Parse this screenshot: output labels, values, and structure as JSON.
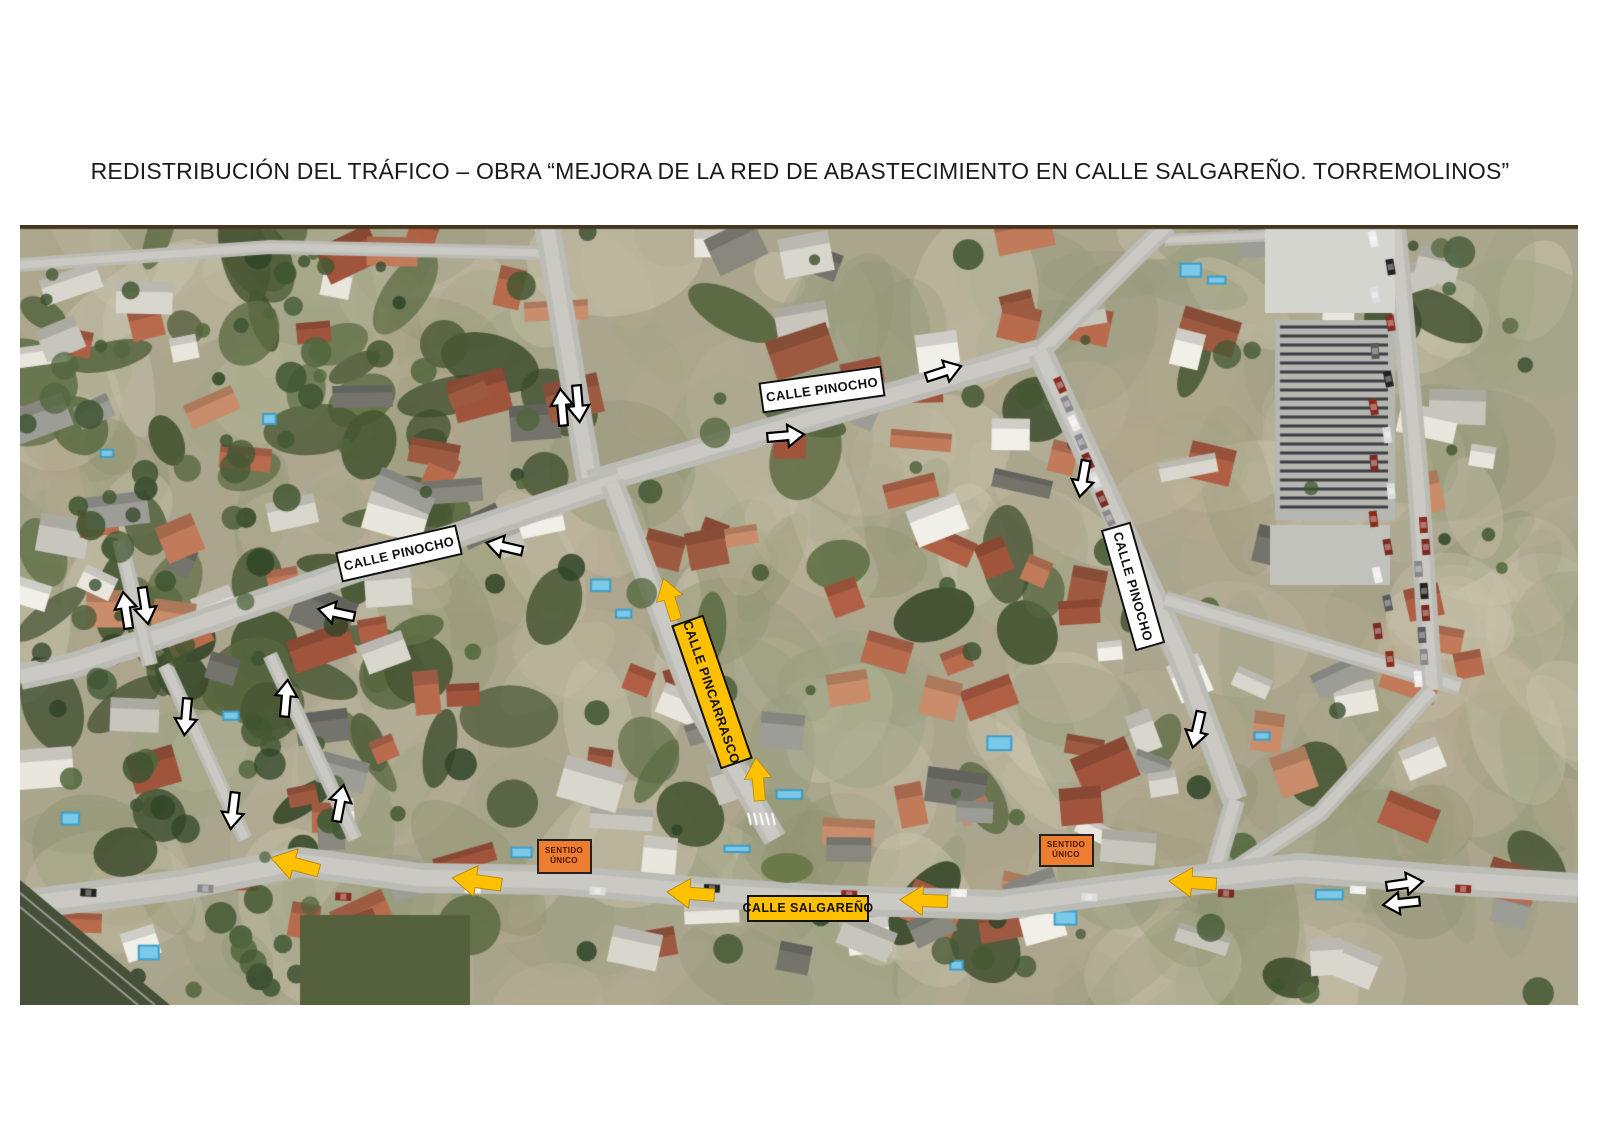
{
  "page_title": "REDISTRIBUCIÓN DEL TRÁFICO – OBRA “MEJORA DE LA RED DE ABASTECIMIENTO EN CALLE SALGAREÑO. TORREMOLINOS”",
  "map": {
    "colors": {
      "street_label_white": "#FFFFFF",
      "street_label_yellow": "#FFC000",
      "one_way_sign_orange": "#ED7D31",
      "arrow_white": "#FFFFFF",
      "arrow_yellow": "#FFC000",
      "outline_black": "#000000"
    },
    "street_labels": [
      {
        "text": "CALLE PINOCHO",
        "variant": "white",
        "x": 822,
        "y": 389,
        "w": 124,
        "h": 31,
        "angle": -8,
        "font": 13
      },
      {
        "text": "CALLE PINOCHO",
        "variant": "white",
        "x": 399,
        "y": 553,
        "w": 124,
        "h": 31,
        "angle": -13,
        "font": 13
      },
      {
        "text": "CALLE PINOCHO",
        "variant": "white",
        "x": 1133,
        "y": 586,
        "w": 126,
        "h": 31,
        "angle": 74,
        "font": 13
      },
      {
        "text": "CALLE PINCARRASCO",
        "variant": "yellow",
        "x": 712,
        "y": 692,
        "w": 152,
        "h": 34,
        "angle": 71,
        "font": 13
      },
      {
        "text": "CALLE SALGAREÑO",
        "variant": "yellow",
        "x": 808,
        "y": 908,
        "w": 122,
        "h": 27,
        "angle": 0,
        "font": 12.5
      }
    ],
    "one_way_signs": [
      {
        "line1": "SENTIDO",
        "line2": "ÚNICO",
        "x": 564,
        "y": 856,
        "w": 55,
        "h": 35
      },
      {
        "line1": "SENTIDO",
        "line2": "ÚNICO",
        "x": 1066,
        "y": 850,
        "w": 55,
        "h": 33
      }
    ],
    "arrows_white": [
      {
        "x": 562,
        "y": 408,
        "angle": -95
      },
      {
        "x": 578,
        "y": 403,
        "angle": 85
      },
      {
        "x": 943,
        "y": 372,
        "angle": -18
      },
      {
        "x": 785,
        "y": 436,
        "angle": -5
      },
      {
        "x": 1083,
        "y": 478,
        "angle": 100
      },
      {
        "x": 505,
        "y": 547,
        "angle": 193
      },
      {
        "x": 337,
        "y": 613,
        "angle": 192
      },
      {
        "x": 126,
        "y": 611,
        "angle": -99
      },
      {
        "x": 145,
        "y": 605,
        "angle": 81
      },
      {
        "x": 186,
        "y": 716,
        "angle": 95
      },
      {
        "x": 286,
        "y": 699,
        "angle": -85
      },
      {
        "x": 233,
        "y": 810,
        "angle": 97
      },
      {
        "x": 340,
        "y": 804,
        "angle": -79
      },
      {
        "x": 1197,
        "y": 729,
        "angle": 103
      },
      {
        "x": 1404,
        "y": 884,
        "angle": -8
      },
      {
        "x": 1402,
        "y": 903,
        "angle": 174
      }
    ],
    "arrows_yellow": [
      {
        "x": 670,
        "y": 600,
        "angle": -107,
        "s": 1.0
      },
      {
        "x": 758,
        "y": 780,
        "angle": -95,
        "s": 1.0
      },
      {
        "x": 296,
        "y": 864,
        "angle": 195,
        "s": 1.15
      },
      {
        "x": 478,
        "y": 881,
        "angle": 188,
        "s": 1.15
      },
      {
        "x": 691,
        "y": 894,
        "angle": 184,
        "s": 1.1
      },
      {
        "x": 924,
        "y": 901,
        "angle": 182,
        "s": 1.1
      },
      {
        "x": 1193,
        "y": 883,
        "angle": 184,
        "s": 1.1
      }
    ]
  }
}
